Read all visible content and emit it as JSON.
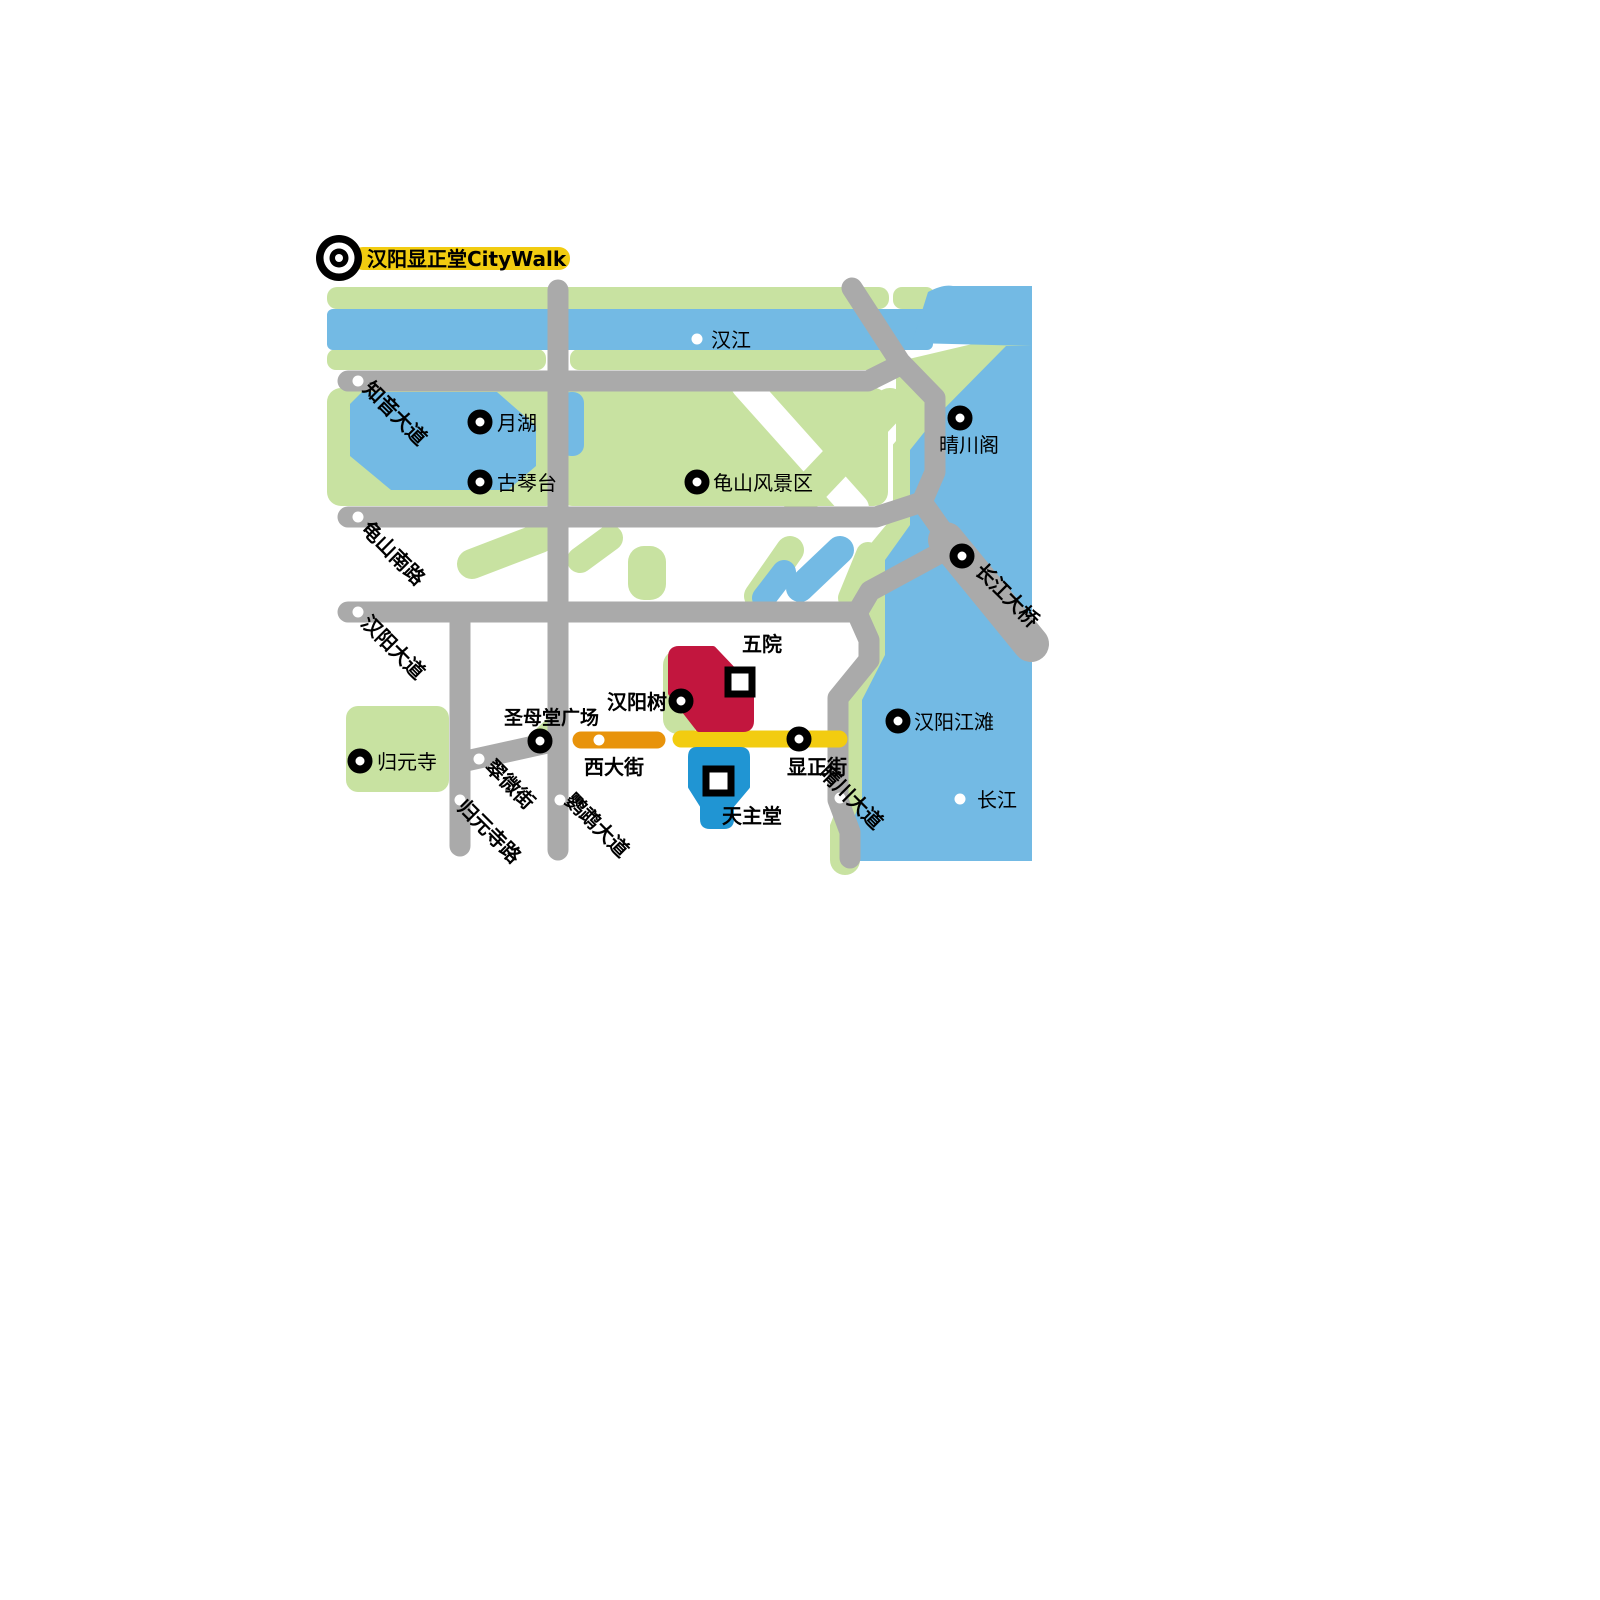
{
  "title": {
    "text": "汉阳显正堂CityWalk",
    "logo": "target-bullseye-icon"
  },
  "colors": {
    "park": "#C8E2A1",
    "water": "#73BAE4",
    "road": "#AAAAAA",
    "highlight_yellow": "#F2CC10",
    "highlight_orange": "#E8930B",
    "building_red": "#C2163E",
    "building_blue": "#2095D3",
    "label": "#000000",
    "marker_fill": "#FFFFFF"
  },
  "water": {
    "hanjiang": {
      "label": "汉江"
    },
    "changjiang": {
      "label": "长江"
    }
  },
  "pois": {
    "yuehu": {
      "label": "月湖",
      "marker": "ring"
    },
    "guqintai": {
      "label": "古琴台",
      "marker": "ring"
    },
    "guishan_scenic": {
      "label": "龟山风景区",
      "marker": "ring"
    },
    "qingchuan_pavilion": {
      "label": "晴川阁",
      "marker": "ring"
    },
    "hanyang_tree": {
      "label": "汉阳树",
      "marker": "ring"
    },
    "shengmutang_square": {
      "label": "圣母堂广场",
      "marker": "ring"
    },
    "guiyuan_temple": {
      "label": "归元寺",
      "marker": "ring"
    },
    "hanyang_riverside": {
      "label": "汉阳江滩",
      "marker": "ring"
    },
    "wuyuan_hospital": {
      "label": "五院",
      "marker": "square"
    },
    "cathedral": {
      "label": "天主堂",
      "marker": "square"
    }
  },
  "streets": {
    "zhiyin_avenue": {
      "label": "知音大道"
    },
    "guishan_south_road": {
      "label": "龟山南路"
    },
    "hanyang_avenue": {
      "label": "汉阳大道"
    },
    "cuiwei_street": {
      "label": "翠微街"
    },
    "guiyuansi_road": {
      "label": "归元寺路"
    },
    "yingwu_avenue": {
      "label": "鹦鹉大道"
    },
    "qingchuan_avenue": {
      "label": "晴川大道"
    },
    "changjiang_bridge": {
      "label": "长江大桥",
      "marker": "ring"
    },
    "xidajie": {
      "label": "西大街",
      "highlight": "orange"
    },
    "xianzhengjie": {
      "label": "显正街",
      "highlight": "yellow",
      "marker": "ring"
    }
  }
}
